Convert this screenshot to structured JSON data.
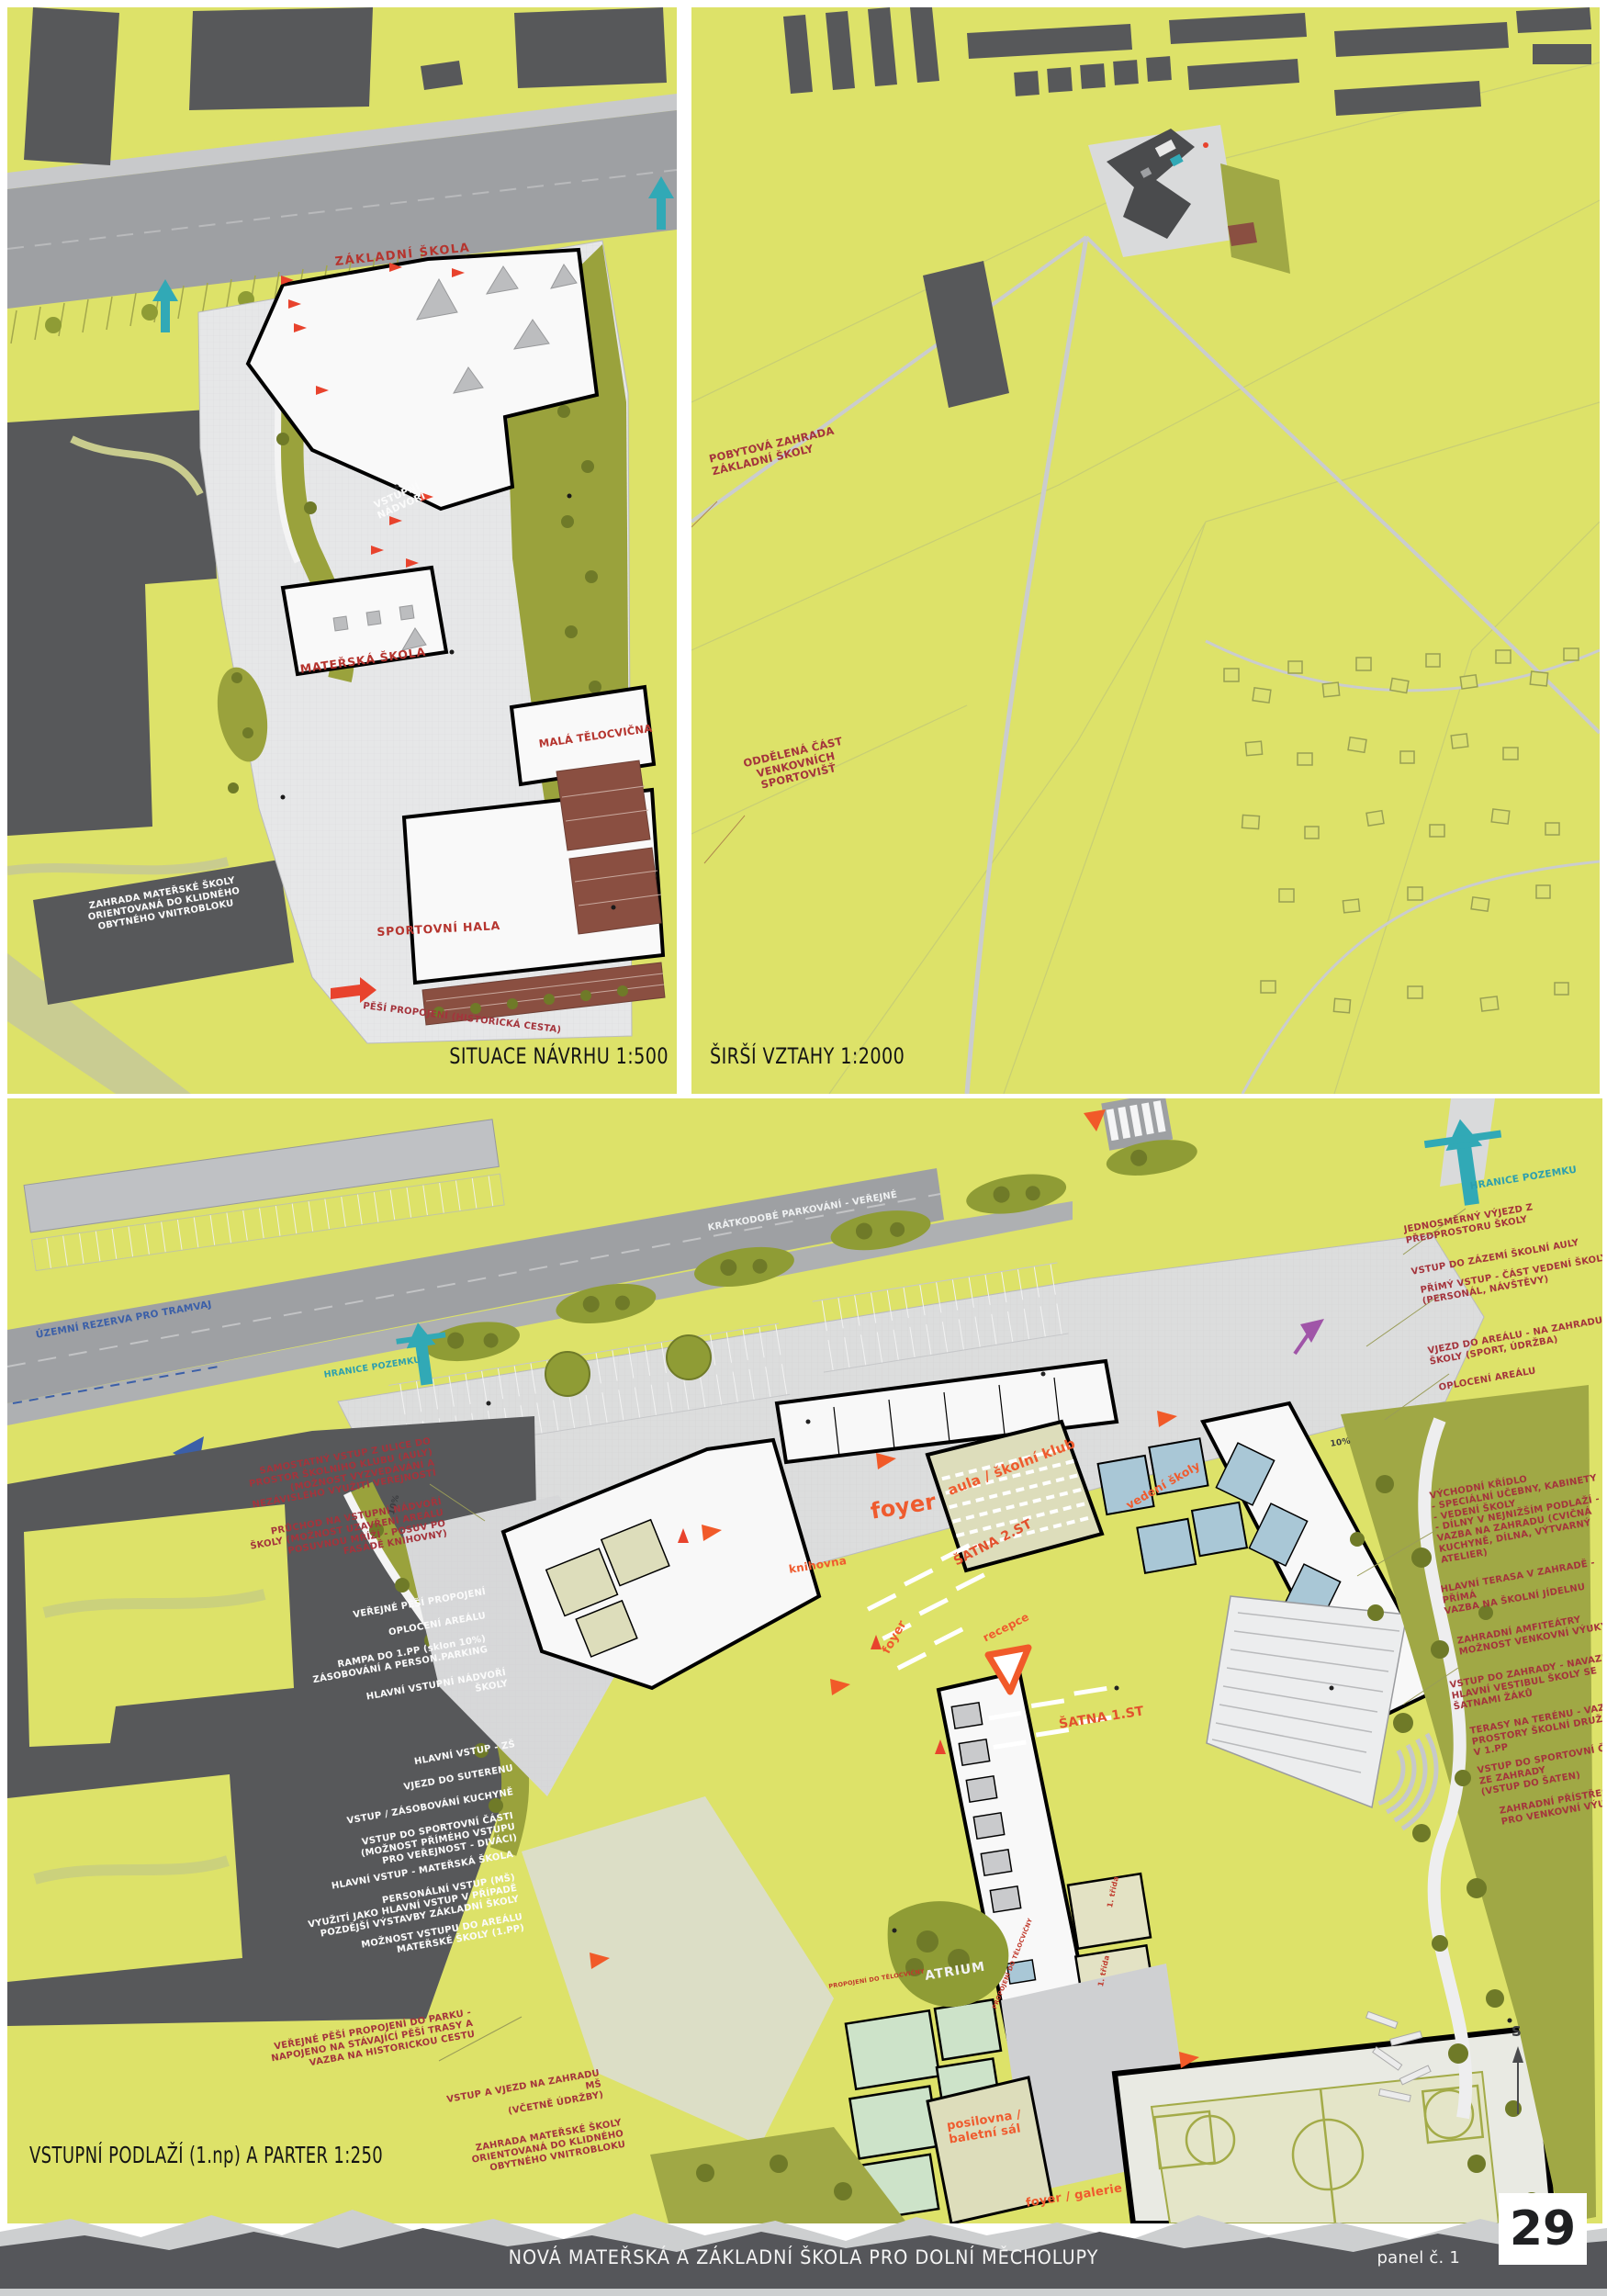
{
  "colors": {
    "base_yellow": "#dde269",
    "road_gray": "#9ea0a3",
    "building_dark": "#57585a",
    "paving_light": "#e4e5e6",
    "olive": "#9aa23c",
    "olive_dark": "#6f7a28",
    "brick_red": "#8a4f41",
    "annotation_red": "#a4343c",
    "plan_label_red": "#b5342e",
    "orange": "#ef5b2e",
    "teal": "#2d9fae",
    "blue": "#3b5fa8",
    "purple": "#a055a8",
    "footer_gray": "#55565a",
    "silhouette_gray": "#cdcfd0",
    "aula_beige": "#ddddbb",
    "room_blue": "#a9c7d6",
    "room_green": "#cde3c9",
    "court_beige": "#e4e5c8"
  },
  "panel_situace": {
    "caption": "SITUACE NÁVRHU 1:500",
    "labels": {
      "zakladni_skola": "ZÁKLADNÍ ŠKOLA",
      "vstupni_nadvori": "VSTUPNÍ\nNÁDVOŘÍ",
      "materska_skola": "MATEŘSKÁ ŠKOLA",
      "mala_telocvicna": "MALÁ TĚLOCVIČNA",
      "sportovni_hala": "SPORTOVNÍ HALA",
      "zahrada_ms": "ZAHRADA MATEŘSKÉ ŠKOLY\nORIENTOVANÁ DO KLIDNÉHO\nOBYTNÉHO VNITROBLOKU",
      "pesi_propojeni": "PĚŠÍ PROPOJENÍ (HISTORICKÁ CESTA)"
    }
  },
  "panel_vztahy": {
    "caption": "ŠIRŠÍ VZTAHY 1:2000",
    "labels": {
      "pobytova_zahrada": "POBYTOVÁ ZAHRADA\nZÁKLADNÍ ŠKOLY",
      "oddelena_cast": "ODDĚLENÁ ČÁST\nVENKOVNÍCH\nSPORTOVIŠŤ"
    }
  },
  "panel_podlazi": {
    "title": "VSTUPNÍ PODLAŽÍ (1.np) A PARTER 1:250",
    "street_labels": {
      "tramvaj": "ÚZEMNÍ REZERVA PRO TRAMVAJ",
      "parkovani": "KRÁTKODOBÉ PARKOVÁNÍ - VEŘEJNÉ",
      "hranice": "HRANICE POZEMKU",
      "slope_a": "10%",
      "slope_b": "10%",
      "north": "S"
    },
    "left_annotations": [
      {
        "text": "SAMOSTATNÝ VSTUP Z ULICE DO\nPROSTOR ŠKOLNÍHO KLUBU (AULY)\n(MOŽNOST VYZVEDÁVÁNÍ A\nNEZÁVISLÉHO VYUŽITÍ VEŘEJNOSTÍ"
      },
      {
        "text": "PRŮCHOD NA VSTUPNÍ NÁDVOŘÍ\nŠKOLY (MOŽNOST UZAVŘENÍ AREÁLU\nPOSUVNOU MŘÍŽÍ - POSUV PO\nFASÁDĚ KNIHOVNY)"
      },
      {
        "text": "VEŘEJNÉ PĚŠÍ PROPOJENÍ"
      },
      {
        "text": "OPLOCENÍ AREÁLU"
      },
      {
        "text": "RAMPA DO 1.PP  (sklon 10%)\nZÁSOBOVÁNÍ A PERSON.PARKING"
      },
      {
        "text": "HLAVNÍ VSTUPNÍ NÁDVOŘÍ\nŠKOLY"
      },
      {
        "text": "HLAVNÍ VSTUP - ZŠ"
      },
      {
        "text": "VJEZD DO SUTERENU"
      },
      {
        "text": "VSTUP / ZÁSOBOVÁNÍ KUCHYNĚ"
      },
      {
        "text": "VSTUP DO SPORTOVNÍ ČÁSTI\n(MOŽNOST PŘÍMÉHO VSTUPU\nPRO VEŘEJNOST - DIVÁCI)"
      },
      {
        "text": "HLAVNÍ VSTUP - MATEŘSKÁ ŠKOLA"
      },
      {
        "text": "PERSONÁLNÍ VSTUP (MŠ)\nVYUŽITÍ JAKO HLAVNÍ VSTUP V PŘÍPADĚ\nPOZDĚJŠÍ VÝSTAVBY ZÁKLADNÍ ŠKOLY"
      },
      {
        "text": "MOŽNOST VSTUPU DO AREÁLU\nMATEŘSKÉ ŠKOLY (1.PP)"
      },
      {
        "text": "VEŘEJNÉ PĚŠÍ PROPOJENÍ DO PARKU -\nNAPOJENO NA STÁVAJÍCÍ PĚŠÍ TRASY A\nVAZBA NA HISTORICKOU CESTU"
      },
      {
        "text": "VSTUP A VJEZD NA ZAHRADU MŠ\n(VČETNĚ ÚDRŽBY)"
      },
      {
        "text": "ZAHRADA MATEŘSKÉ ŠKOLY\nORIENTOVANÁ DO KLIDNÉHO\nOBYTNÉHO VNITROBLOKU"
      }
    ],
    "right_annotations": [
      {
        "text": "HRANICE POZEMKU"
      },
      {
        "text": "JEDNOSMĚRNÝ VÝJEZD Z\nPŘEDPROSTORU ŠKOLY"
      },
      {
        "text": "VSTUP DO ZÁZEMÍ ŠKOLNÍ AULY"
      },
      {
        "text": "PŘÍMÝ VSTUP - ČÁST VEDENÍ ŠKOLY\n(PERSONÁL, NÁVŠTĚVY)"
      },
      {
        "text": "VJEZD DO AREÁLU - NA ZAHRADU\nŠKOLY (SPORT, ÚDRŽBA)"
      },
      {
        "text": "OPLOCENÍ AREÁLU"
      },
      {
        "text": "VÝCHODNÍ KŘÍDLO\n- SPECIÁLNÍ UČEBNY, KABINETY\n- VEDENÍ ŠKOLY\n- DÍLNY V NEJNIŽŠÍM PODLAŽÍ -\nVAZBA NA ZAHRADU (CVIČNÁ\nKUCHYNĚ, DÍLNA, VÝTVARNÝ\nATELIER)"
      },
      {
        "text": "HLAVNÍ TERASA V ZAHRADĚ - PŘÍMÁ\nVAZBA NA ŠKOLNÍ JÍDELNU"
      },
      {
        "text": "ZAHRADNÍ AMFITEÁTRY\nMOŽNOST VENKOVNÍ VÝUKY"
      },
      {
        "text": "VSTUP DO ZAHRADY - NAVAZUJE NA\nHLAVNÍ VESTIBUL ŠKOLY SE\nŠATNAMI ŽÁKŮ"
      },
      {
        "text": "TERASY NA TERÉNU - VAZBA NA\nPROSTORY ŠKOLNÍ DRUŽINY\nV 1.PP"
      },
      {
        "text": "VSTUP DO SPORTOVNÍ ČÁSTI\nZE ZAHRADY\n(VSTUP DO ŠATEN)"
      },
      {
        "text": "ZAHRADNÍ PŘÍSTŘEŠEK\nPRO VENKOVNÍ VÝUKU"
      }
    ],
    "plan_labels": {
      "foyer": "foyer",
      "knihovna": "knihovna",
      "aula": "aula / školní klub",
      "satna2": "ŠATNA 2.ST",
      "vedeni": "vedení školy",
      "recepce": "recepce",
      "foyer2": "foyer",
      "satna1": "ŠATNA 1.ST",
      "atrium": "ATRIUM",
      "posilovna": "posilovna /\nbaletní sál",
      "foyer_galerie": "foyer / galerie",
      "trida_a": "1. třída",
      "trida_b": "1. třída",
      "propojeni_a": "PROPOJENÍ DO TĚLOCVIČNY",
      "propojeni_b": "PROPOJENÍ DO TĚLOCVIČNY"
    }
  },
  "footer": {
    "project_title": "NOVÁ MATEŘSKÁ A ZÁKLADNÍ ŠKOLA PRO DOLNÍ MĚCHOLUPY",
    "panel_label": "panel č. 1",
    "panel_number": "29"
  }
}
